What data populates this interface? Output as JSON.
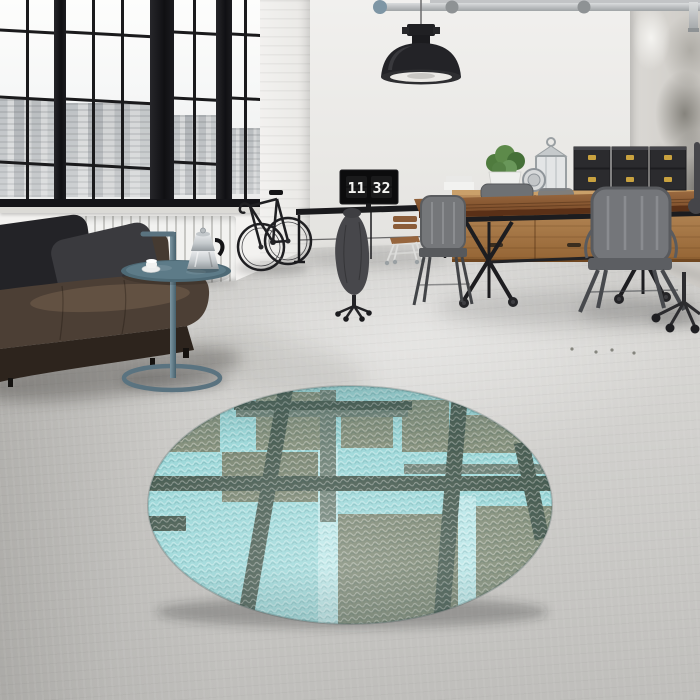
{
  "scene": {
    "type": "interior-photograph",
    "description": "Industrial loft living room with black steel factory windows, dark leather sofa, workspace desks and a round plaid rug on a concrete floor",
    "clock": {
      "hours": "11",
      "minutes": "32",
      "display": "11 32"
    }
  },
  "rug": {
    "shape": "round",
    "pattern": "plaid-squares",
    "colors": {
      "base": "#9FD9DA",
      "block": "#87927E",
      "block_dark": "#7F8A76",
      "stripe_dark": "#4D6055",
      "stripe_mid": "#74867B",
      "stripe_light": "#BCE7E8"
    }
  },
  "palette": {
    "wall": "#EAE9E6",
    "floor": "#CFCECB",
    "window_frame": "#16161A",
    "sofa_leather": "#4C3F35",
    "pillow_dark": "#232327",
    "pillow_grey": "#3A3A3E",
    "side_table_teal": "#5A7380",
    "wood_light": "#B68A58",
    "wood_dark": "#7C4C29",
    "metal_chair": "#74767A",
    "box_black": "#2B2B2E",
    "box_clasp": "#C9A23F",
    "plant_green": "#5D8A4A",
    "lamp_black": "#232327"
  },
  "objects": [
    "pendant lamp",
    "ceiling pipes",
    "factory windows",
    "city skyline",
    "radiator",
    "leather sofa",
    "cushions",
    "tray side table",
    "moka pot",
    "espresso cup",
    "road bicycle",
    "wall desk",
    "monitor flip clock",
    "office chair with jacket",
    "wooden chair",
    "wooden sideboard",
    "black storage boxes",
    "lantern",
    "potted plant",
    "industrial dining table",
    "metal cafe chairs",
    "office chair",
    "round plaid rug",
    "concrete floor",
    "distressed corner wall"
  ]
}
